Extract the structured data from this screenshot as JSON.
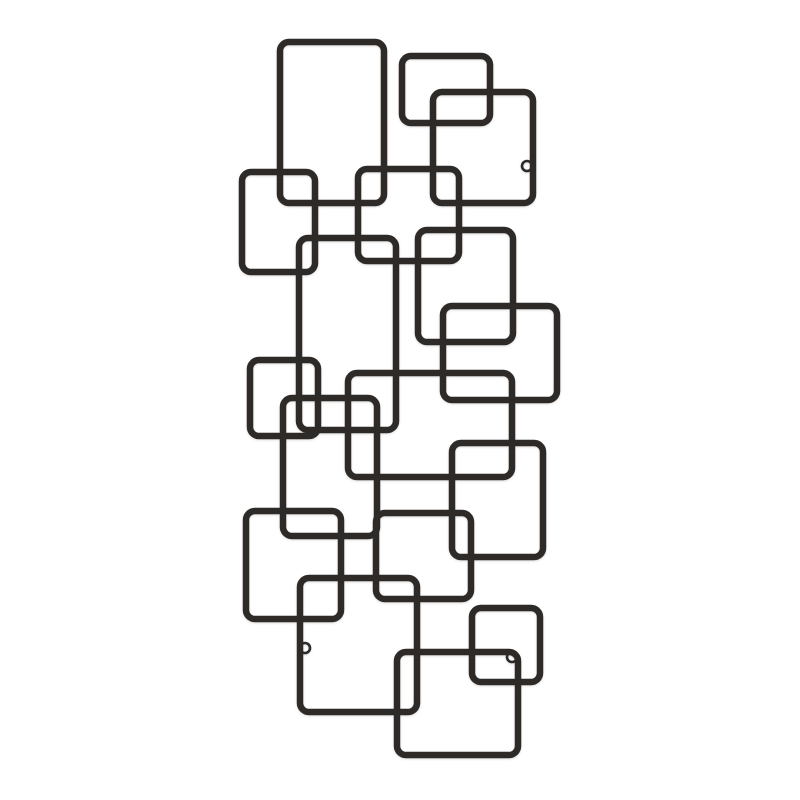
{
  "page": {
    "background_color": "#ffffff",
    "description": "Product photograph of a black metal wall decor sculpture made of interlocking square and rectangular wire frames on a plain white background"
  },
  "artwork": {
    "wire_color": "#2d2a28",
    "wire_thickness": 6.5,
    "corner_radius": 9,
    "ring_radius": 5,
    "ring_thickness": 2.6,
    "squares": [
      {
        "name": "wire-square-tall-top",
        "x": 280,
        "y": 42,
        "w": 104,
        "h": 161
      },
      {
        "name": "wire-square-top-small",
        "x": 402,
        "y": 56,
        "w": 88,
        "h": 67
      },
      {
        "name": "wire-square-top-right",
        "x": 433,
        "y": 92,
        "w": 100,
        "h": 111
      },
      {
        "name": "wire-square-upper-left",
        "x": 242,
        "y": 172,
        "w": 73,
        "h": 100
      },
      {
        "name": "wire-square-upper-center",
        "x": 358,
        "y": 169,
        "w": 101,
        "h": 92
      },
      {
        "name": "wire-rect-tall-center-left",
        "x": 299,
        "y": 238,
        "w": 97,
        "h": 192
      },
      {
        "name": "wire-square-mid-right-upper",
        "x": 418,
        "y": 230,
        "w": 95,
        "h": 112
      },
      {
        "name": "wire-square-mid-right-wide",
        "x": 443,
        "y": 306,
        "w": 114,
        "h": 94
      },
      {
        "name": "wire-square-mid-left-small",
        "x": 250,
        "y": 360,
        "w": 68,
        "h": 76
      },
      {
        "name": "wire-rect-center-wide",
        "x": 348,
        "y": 373,
        "w": 164,
        "h": 104
      },
      {
        "name": "wire-rect-center-tall-small",
        "x": 283,
        "y": 398,
        "w": 94,
        "h": 138
      },
      {
        "name": "wire-square-right-lower",
        "x": 452,
        "y": 443,
        "w": 91,
        "h": 114
      },
      {
        "name": "wire-square-lower-left-big",
        "x": 246,
        "y": 511,
        "w": 95,
        "h": 108
      },
      {
        "name": "wire-square-lower-center",
        "x": 376,
        "y": 513,
        "w": 95,
        "h": 86
      },
      {
        "name": "wire-square-bottom-big",
        "x": 300,
        "y": 578,
        "w": 117,
        "h": 134
      },
      {
        "name": "wire-square-bottom-small",
        "x": 472,
        "y": 608,
        "w": 68,
        "h": 74
      },
      {
        "name": "wire-square-bottom-right",
        "x": 397,
        "y": 652,
        "w": 121,
        "h": 103
      }
    ],
    "mounting_rings": [
      {
        "name": "mounting-ring-top-right",
        "cx": 527,
        "cy": 166
      },
      {
        "name": "mounting-ring-bottom-left",
        "cx": 305,
        "cy": 648
      },
      {
        "name": "mounting-ring-bottom-right",
        "cx": 512,
        "cy": 657
      }
    ]
  }
}
